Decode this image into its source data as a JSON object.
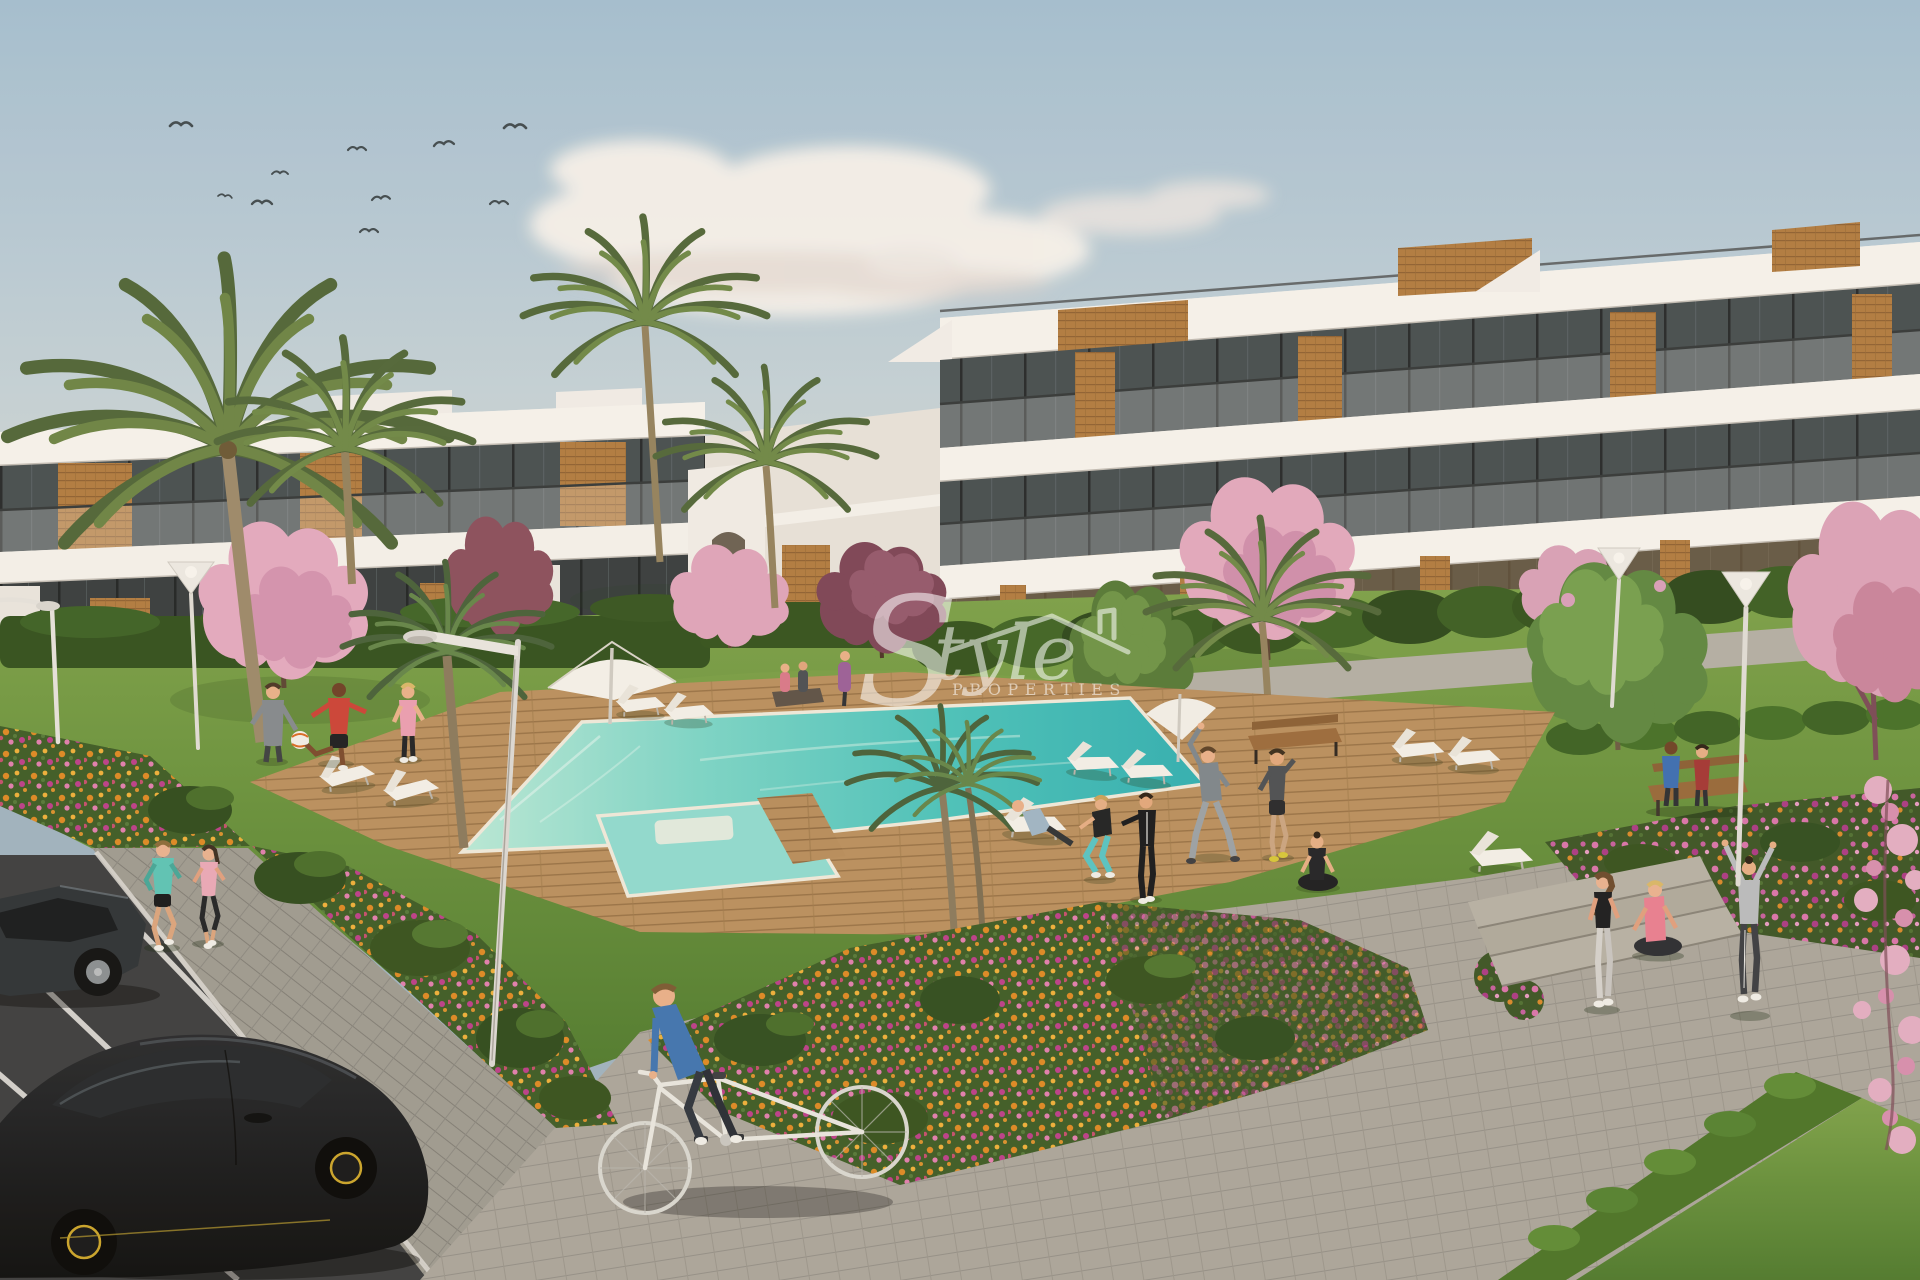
{
  "watermark": {
    "brand_initial": "S",
    "brand_rest": "tyle",
    "brand_sub": "PROPERTIES"
  },
  "scene": {
    "type": "architectural-render-apartment-complex",
    "palette": {
      "sky_top": "#a3bfd3",
      "sky_horizon": "#e8dfd2",
      "building_white": "#f6f4f0",
      "wood_accent": "#b07c42",
      "glass": "#454e52",
      "lawn_green": "#648f3c",
      "hedge_green": "#3a5c26",
      "pool_water": "#49c3bd",
      "deck_wood": "#b78e5e",
      "flower_orange": "#dd8a25",
      "flower_pink": "#d874ac",
      "blossom_pink": "#e2a9c0",
      "paver_gray": "#a9a59d",
      "asphalt": "#44474a",
      "car_black": "#17191c",
      "lamp_pole": "#e4e2de",
      "watermark_white": "#ffffff"
    }
  }
}
